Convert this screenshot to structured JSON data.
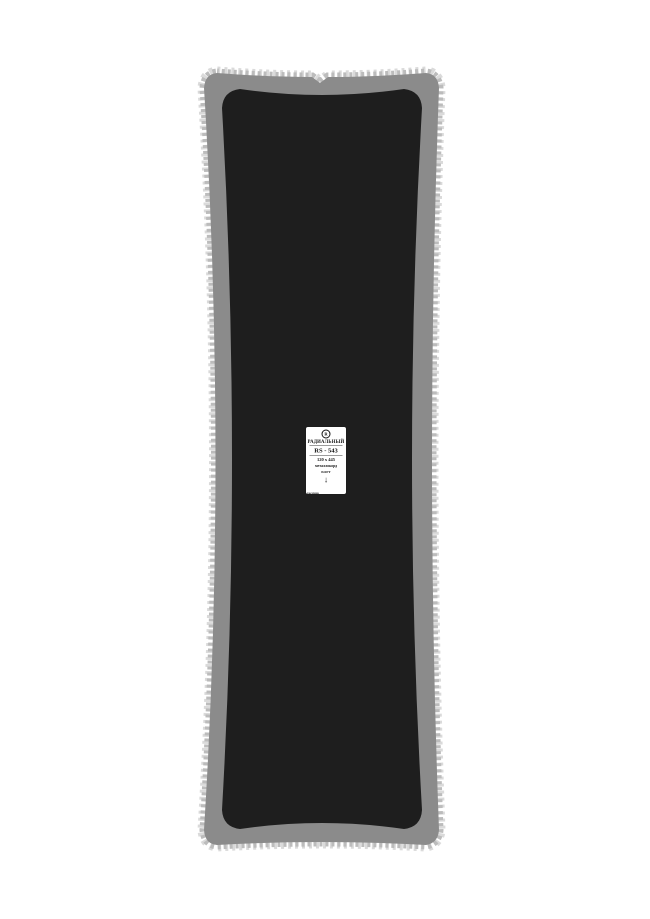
{
  "label": {
    "logo_letter": "R",
    "type": "РАДИАЛЬНЫЙ",
    "model": "RS - 543",
    "size": "120 х 445",
    "cord": "металлокорд",
    "bead": "БОРТ",
    "arrow": "↓",
    "brand": "россвик"
  },
  "colors": {
    "background": "#ffffff",
    "patch_edge_gray": "#8b8b8b",
    "serration_light": "#bcbcbc",
    "serration_faint": "#dadada",
    "patch_black": "#1e1e1e",
    "label_bg": "#ffffff",
    "label_border": "#1c1c1c",
    "label_text": "#111111"
  }
}
